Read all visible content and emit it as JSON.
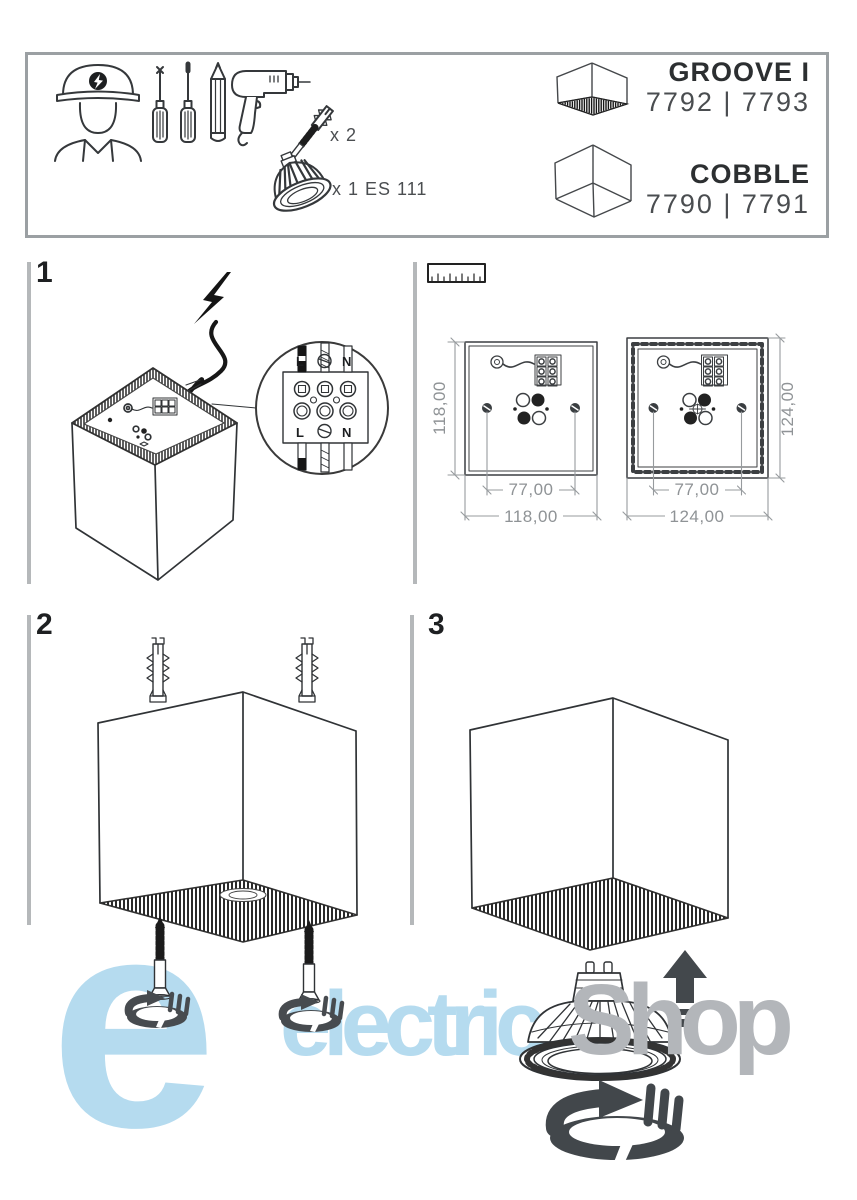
{
  "kit": {
    "anchor_qty": "x 2",
    "bulb_qty": "x 1 ES 111"
  },
  "products": {
    "groove": {
      "name": "GROOVE I",
      "codes": "7792 | 7793"
    },
    "cobble": {
      "name": "COBBLE",
      "codes": "7790 | 7791"
    }
  },
  "steps": {
    "s1": "1",
    "s2": "2",
    "s3": "3"
  },
  "wiring": {
    "live": "L",
    "neutral": "N"
  },
  "dimensions": {
    "small": {
      "side": "118,00",
      "holes": "77,00"
    },
    "large": {
      "side": "124,00",
      "holes": "77,00"
    }
  },
  "watermark": {
    "logo": "e",
    "brand": "electrica",
    "suffix": "Shop"
  },
  "colors": {
    "line": "#2b2d2f",
    "icon_dark": "#45494d",
    "dim_gray": "#8f9396",
    "accent_blue": "#b5dbef",
    "watermark_gray": "#b3b6ba"
  }
}
